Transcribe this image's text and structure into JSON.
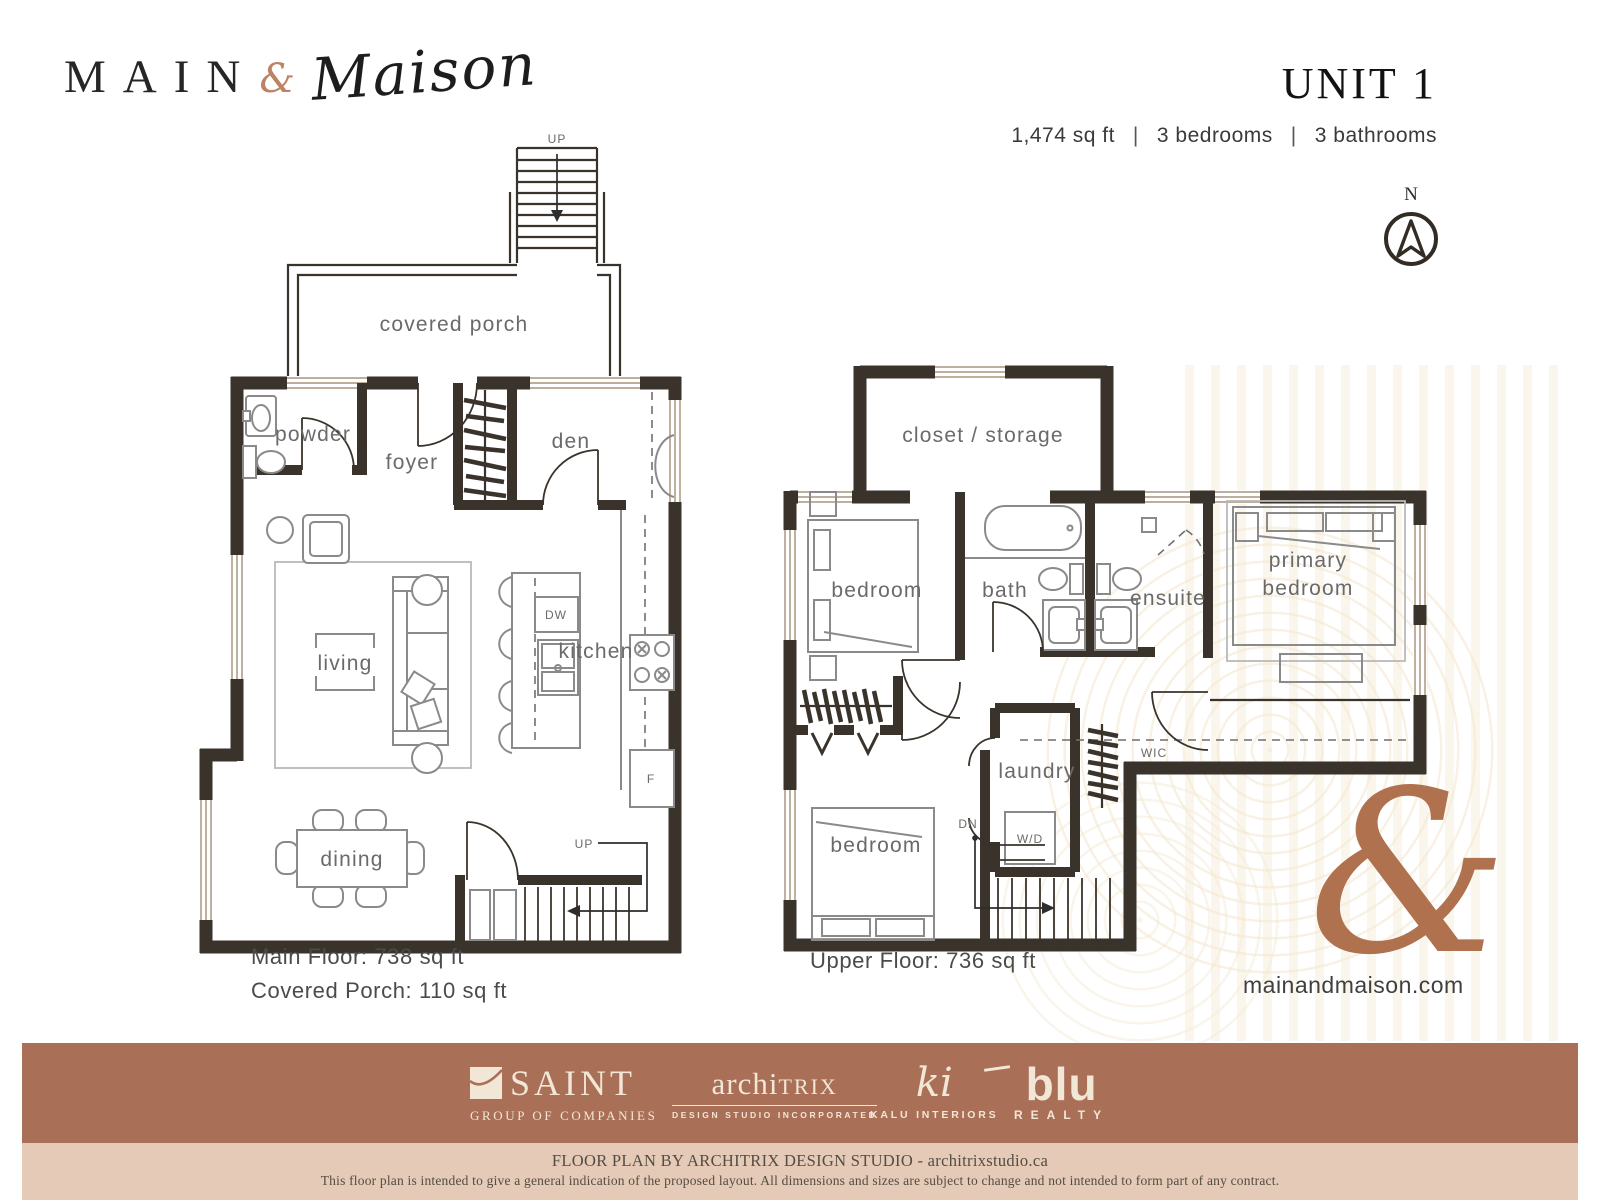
{
  "header": {
    "brand": {
      "main": "MAIN",
      "ampersand": "&",
      "maison": "Maison"
    },
    "unit_title": "UNIT 1",
    "specs": {
      "sqft": "1,474 sq ft",
      "bedrooms": "3 bedrooms",
      "bathrooms": "3 bathrooms",
      "separator": "|"
    },
    "compass_label": "N"
  },
  "main_floor": {
    "labels": {
      "up_top": "UP",
      "covered_porch": "covered porch",
      "powder": "powder",
      "foyer": "foyer",
      "den": "den",
      "living": "living",
      "kitchen": "kitchen",
      "dining": "dining",
      "dishwasher": "DW",
      "fridge": "F",
      "up_stairs": "UP"
    },
    "area": "Main Floor: 738 sq ft",
    "porch_area": "Covered Porch: 110 sq ft"
  },
  "upper_floor": {
    "labels": {
      "closet_storage": "closet / storage",
      "bedroom_front": "bedroom",
      "bath": "bath",
      "ensuite": "ensuite",
      "primary_line1": "primary",
      "primary_line2": "bedroom",
      "laundry": "laundry",
      "washer_dryer": "W/D",
      "down_stairs": "DN",
      "bedroom_rear": "bedroom",
      "wic": "WIC"
    },
    "area": "Upper Floor: 736 sq ft"
  },
  "branding": {
    "ampersand_watermark": "&",
    "website": "mainandmaison.com"
  },
  "footer": {
    "partners": {
      "saint": {
        "name": "SAINT",
        "tagline": "GROUP OF COMPANIES"
      },
      "architrix": {
        "name_prefix": "archi",
        "name_suffix": "TRIX",
        "tagline": "DESIGN STUDIO INCORPORATED"
      },
      "kalu": {
        "monogram": "ki",
        "tagline": "KALU INTERIORS"
      },
      "blu": {
        "name": "blu",
        "tagline": "REALTY"
      }
    },
    "credit": "FLOOR PLAN BY ARCHITRIX DESIGN STUDIO - architrixstudio.ca",
    "disclaimer": "This floor plan is intended to give a general indication of the proposed layout. All dimensions and sizes are subject to change and not intended to form part of any contract."
  },
  "colors": {
    "wall_dark": "#3a332b",
    "accent_copper": "#b0714f",
    "logo_copper": "#bd8365",
    "footer_band": "#aa6f57",
    "footer_band_light": "#e4cab7",
    "footer_text_cream": "#f2e6d7"
  }
}
